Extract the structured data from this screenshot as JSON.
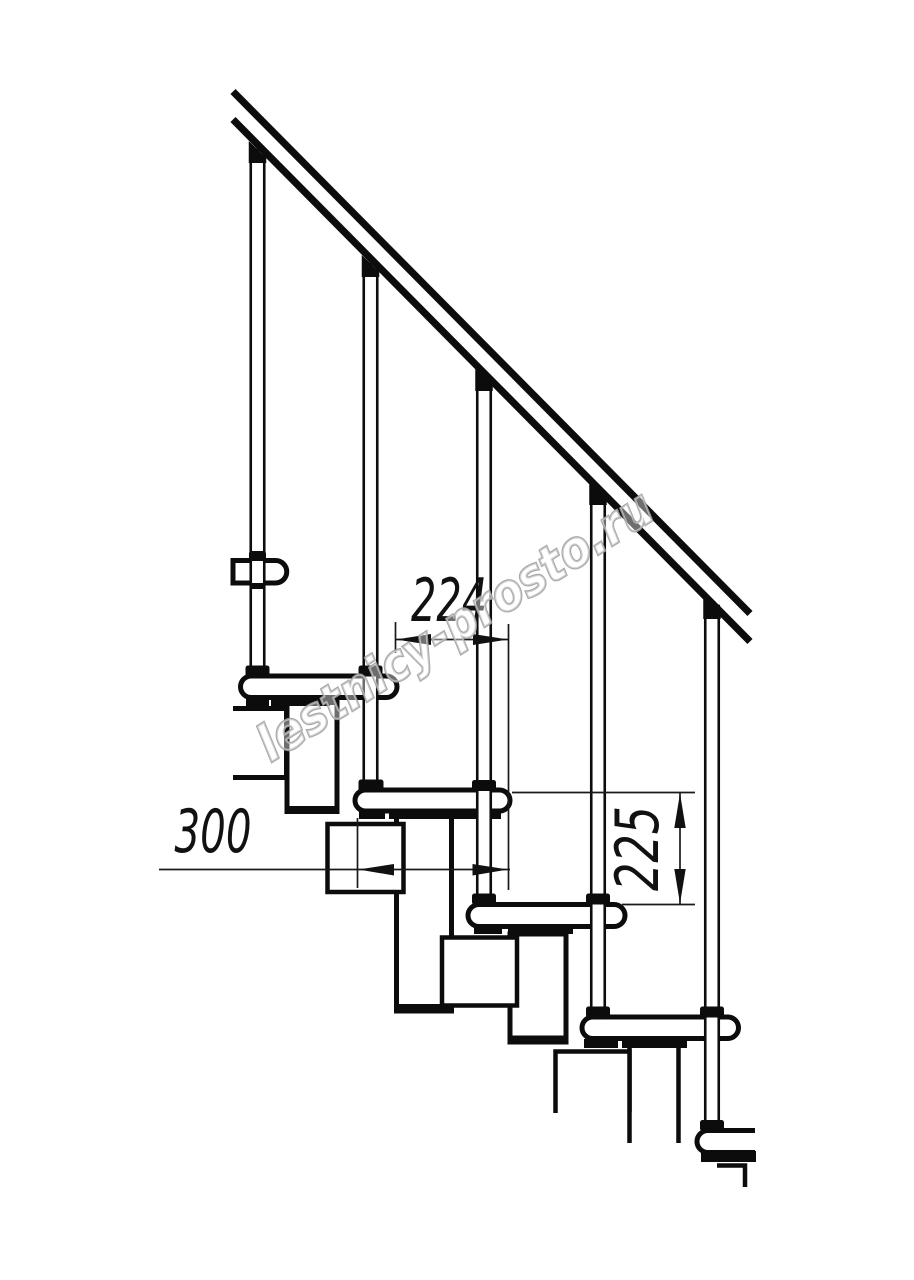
{
  "drawing": {
    "type": "staircase-side-view-technical-drawing",
    "dimensions": {
      "run": "224",
      "tread_depth": "300",
      "rise": "225"
    },
    "watermark": "lestnicy-prosto.ru",
    "colors": {
      "line": "#0c0c0c",
      "dimension": "#1a1a1a",
      "watermark": "#a0a0a0",
      "background": "#ffffff"
    }
  }
}
